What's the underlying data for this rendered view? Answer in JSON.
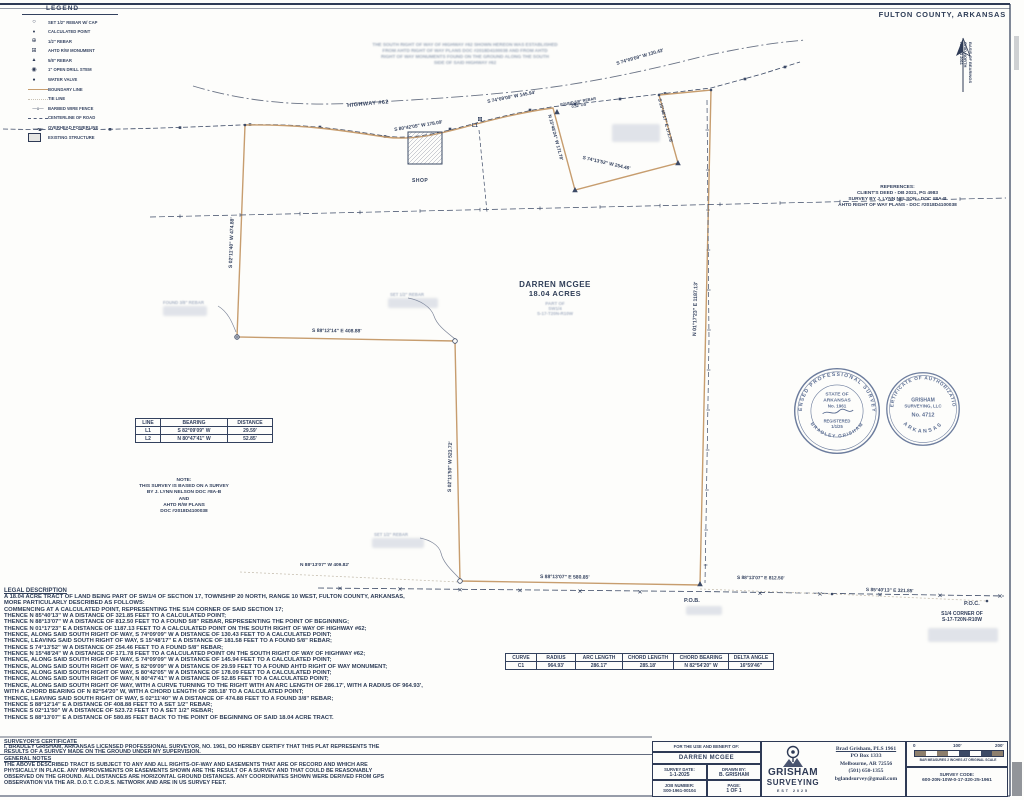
{
  "page": {
    "county_title": "FULTON COUNTY, ARKANSAS"
  },
  "legend": {
    "title": "LEGEND",
    "items": [
      {
        "icon": "set-rebar-cap-icon",
        "label": "SET 1/2\" REBAR W/ CAP"
      },
      {
        "icon": "calculated-point-icon",
        "label": "CALCULATED POINT"
      },
      {
        "icon": "half-inch-rebar-icon",
        "label": "1/2\" REBAR"
      },
      {
        "icon": "ahtd-rw-monument-icon",
        "label": "AHTD R/W MONUMENT"
      },
      {
        "icon": "five-eighths-rebar-icon",
        "label": "5/8\" REBAR"
      },
      {
        "icon": "drill-stem-icon",
        "label": "1\" OPEN DRILL STEM"
      },
      {
        "icon": "water-valve-icon",
        "label": "WATER VALVE"
      },
      {
        "icon": "boundary-line-icon",
        "label": "BOUNDARY LINE"
      },
      {
        "icon": "tie-line-icon",
        "label": "TIE LINE"
      },
      {
        "icon": "barbed-wire-fence-icon",
        "label": "BARBED WIRE FENCE"
      },
      {
        "icon": "centerline-of-road-icon",
        "label": "CENTERLINE OF ROAD"
      },
      {
        "icon": "overhead-powerline-icon",
        "label": "OVERHEAD POWERLINE"
      },
      {
        "icon": "existing-structure-icon",
        "label": "EXISTING STRUCTURE"
      }
    ]
  },
  "north_arrow": {
    "lines": [
      "BASIS OF BEARINGS",
      "GRID NORTH",
      "NAD83 2011"
    ]
  },
  "row_note": {
    "lines": [
      "THE SOUTH RIGHT OF WAY OF HIGHWAY #62 SHOWN HEREON WAS ESTABLISHED",
      "FROM AHTD RIGHT OF WAY PLANS DOC #2018D4100038 AND FROM AHTD",
      "RIGHT OF WAY MONUMENTS FOUND ON THE GROUND ALONG THE SOUTH",
      "SIDE OF SAID HIGHWAY #62"
    ]
  },
  "references": {
    "title": "REFERENCES:",
    "lines": [
      "CLIENT'S DEED - DB 2021, PG 4983",
      "SURVEY BY J. LYNN NELSON - DOC #8A-B",
      "AHTD RIGHT OF WAY PLANS - DOC #2018D4100038"
    ]
  },
  "tract": {
    "owner": "DARREN MCGEE",
    "area": "18.04 ACRES",
    "sub1": "PART OF",
    "sub2": "SW1/4",
    "sub3": "S-17-T20N-R10W"
  },
  "labels": {
    "highway": "HIGHWAY #62",
    "shop": "SHOP",
    "pob": "P.O.B.",
    "poc": "P.O.C.",
    "corner1": "S1/4 CORNER OF",
    "corner2": "S-17-T20N-R10W",
    "l1": "L1",
    "found_rebar": "FOUND 5/8\" REBAR",
    "found_rebar_os": "0.52' OS",
    "faint_found38": "FOUND 3/8\" REBAR",
    "faint_set12_a": "SET 1/2\" REBAR",
    "faint_set12_b": "SET 1/2\" REBAR"
  },
  "bearings": {
    "hw145": "S 74°09'09\" W 145.94'",
    "hw130": "S 74°09'09\" W 130.43'",
    "hw178": "S 80°42'05\" W 178.09'",
    "notch_w": "N 15°48'24\" W 171.78'",
    "notch_e": "S 15°48'17\" E 171.78'",
    "notch_s": "S 74°13'52\" W 254.46'",
    "east": "N 01°17'23\" E 1187.13'",
    "west": "S 02°11'40\" W 474.88'",
    "step": "S 88°12'14\" E 408.88'",
    "mid": "S 02°11'50\" W 523.72'",
    "south": "S 88°13'07\" E 580.85'",
    "tie_w": "N 88°13'07\" W 409.82'",
    "tie_e": "S 88°13'07\" E 812.50'",
    "poc_tie": "S 85°40'13\" E 321.85'"
  },
  "note_block": {
    "lines": [
      "NOTE:",
      "THIS SURVEY IS BASED ON A SURVEY",
      "BY J. LYNN NELSON DOC #8A-B",
      "AND",
      "AHTD R/W PLANS",
      "DOC #2018D4100038"
    ]
  },
  "line_table": {
    "headers": [
      "LINE",
      "BEARING",
      "DISTANCE"
    ],
    "rows": [
      [
        "L1",
        "S 82°09'09\" W",
        "29.59'"
      ],
      [
        "L2",
        "N 80°47'41\" W",
        "52.85'"
      ]
    ]
  },
  "curve_table": {
    "headers": [
      "CURVE",
      "RADIUS",
      "ARC LENGTH",
      "CHORD LENGTH",
      "CHORD BEARING",
      "DELTA ANGLE"
    ],
    "rows": [
      [
        "C1",
        "964.93'",
        "286.17'",
        "285.18'",
        "N 82°54'20\" W",
        "16°59'46\""
      ]
    ]
  },
  "legal": {
    "title": "LEGAL DESCRIPTION",
    "lines": [
      "A 18.04 ACRE TRACT OF LAND BEING PART OF SW1/4 OF SECTION 17, TOWNSHIP 20 NORTH, RANGE 10 WEST, FULTON COUNTY, ARKANSAS,",
      "MORE PARTICULARLY DESCRIBED AS FOLLOWS:",
      "COMMENCING AT A CALCULATED POINT, REPRESENTING THE S1/4 CORNER OF SAID SECTION 17;",
      "THENCE N 85°40'13\" W A DISTANCE OF 321.85 FEET TO A CALCULATED POINT;",
      "THENCE N 88°13'07\" W A DISTANCE OF 812.50 FEET TO A FOUND 5/8\" REBAR, REPRESENTING THE POINT OF BEGINNING;",
      "THENCE N 01°17'23\" E A DISTANCE OF 1187.13 FEET TO A CALCULATED POINT ON THE SOUTH RIGHT OF WAY OF HIGHWAY #62;",
      "THENCE, ALONG SAID SOUTH RIGHT OF WAY, S 74°09'09\" W A DISTANCE OF 130.43 FEET TO A CALCULATED POINT;",
      "THENCE, LEAVING SAID SOUTH RIGHT OF WAY, S 15°48'17\" E A DISTANCE OF 181.58 FEET TO A FOUND 5/8\" REBAR;",
      "THENCE S 74°13'52\" W A DISTANCE OF 254.46 FEET TO A FOUND 5/8\" REBAR;",
      "THENCE N 15°48'24\" W A DISTANCE OF 171.78 FEET TO A CALCULATED POINT ON THE SOUTH RIGHT OF WAY OF HIGHWAY #62;",
      "THENCE, ALONG SAID SOUTH RIGHT OF WAY, S 74°09'09\" W A DISTANCE OF 145.94 FEET TO A CALCULATED POINT;",
      "THENCE, ALONG SAID SOUTH RIGHT OF WAY, S 82°09'09\" W A DISTANCE OF 29.59 FEET TO A FOUND AHTD RIGHT OF WAY MONUMENT;",
      "THENCE, ALONG SAID SOUTH RIGHT OF WAY, S 80°42'05\" W A DISTANCE OF 178.09 FEET TO A CALCULATED POINT;",
      "THENCE, ALONG SAID SOUTH RIGHT OF WAY, N 80°47'41\" W A DISTANCE OF 52.85 FEET TO A CALCULATED POINT;",
      "THENCE, ALONG SAID SOUTH RIGHT OF WAY, WITH A CURVE TURNING TO THE RIGHT WITH AN ARC LENGTH OF 286.17', WITH A RADIUS OF 964.93',",
      "WITH A CHORD BEARING OF N 82°54'20\" W, WITH A CHORD LENGTH OF 285.18' TO A CALCULATED POINT;",
      "THENCE, LEAVING SAID SOUTH RIGHT OF WAY, S 02°11'40\" W A DISTANCE OF 474.88 FEET TO A FOUND 3/8\" REBAR;",
      "THENCE S 88°12'14\" E A DISTANCE OF 408.88 FEET TO A SET 1/2\" REBAR;",
      "THENCE S 02°11'50\" W A DISTANCE OF 523.72 FEET TO A SET 1/2\" REBAR;",
      "THENCE S 88°13'07\" E A DISTANCE OF 580.85 FEET BACK TO THE POINT OF BEGINNING OF SAID 18.04 ACRE TRACT."
    ]
  },
  "cert": {
    "title": "SURVEYOR'S CERTIFICATE",
    "lines": [
      "I, BRADLEY GRISHAM, ARKANSAS LICENSED PROFESSIONAL SURVEYOR, NO. 1961, DO HEREBY CERTIFY THAT THIS PLAT REPRESENTS THE",
      "RESULTS OF A SURVEY MADE ON THE GROUND UNDER MY SUPERVISION."
    ]
  },
  "notes": {
    "title": "GENERAL NOTES",
    "lines": [
      "THE ABOVE DESCRIBED TRACT IS SUBJECT TO ANY AND ALL RIGHTS-OF-WAY AND EASEMENTS THAT ARE OF RECORD AND WHICH ARE",
      "PHYSICALLY IN PLACE. ANY IMPROVEMENTS OR EASEMENTS SHOWN ARE THE RESULT OF A SURVEY AND THAT COULD BE REASONABLY",
      "OBSERVED ON THE GROUND. ALL DISTANCES ARE HORIZONTAL GROUND DISTANCES. ANY COORDINATES SHOWN WERE DERIVED FROM GPS",
      "OBSERVATION VIA THE AR. D.O.T. C.O.R.S. NETWORK AND ARE IN US SURVEY FEET."
    ]
  },
  "seal_pls": {
    "ring": "LICENSED PROFESSIONAL SURVEYOR",
    "state1": "STATE OF",
    "state2": "ARKANSAS",
    "number": "No. 1961",
    "registered": "REGISTERED",
    "date": "1/1/25",
    "name": "BRADLEY GRISHAM"
  },
  "seal_coa": {
    "ring": "CERTIFICATE OF AUTHORIZATION",
    "firm1": "GRISHAM",
    "firm2": "SURVEYING, LLC",
    "number": "No. 4712",
    "state": "ARKANSAS"
  },
  "title_block": {
    "use_label": "FOR THE USE AND BENEFIT OF:",
    "client": "DARREN MCGEE",
    "survey_date_label": "SURVEY DATE:",
    "survey_date": "1-1-2025",
    "drawn_by_label": "DRAWN BY:",
    "drawn_by": "B. GRISHAM",
    "job_label": "JOB NUMBER:",
    "job_number": "S00-1961-00104",
    "page_label": "PAGE:",
    "page": "1 OF 1",
    "firm_name1": "GRISHAM",
    "firm_name2": "SURVEYING",
    "firm_est": "EST  2025",
    "contact_lines": [
      "Brad Grisham, PLS 1961",
      "PO Box 1333",
      "Melbourne, AR 72556",
      "(501) 650-1355",
      "bglandsurvey@gmail.com"
    ],
    "scale": {
      "tick0": "0",
      "tick100": "100'",
      "tick200": "200'",
      "note": "BAR MEASURES 2 INCHES AT ORIGINAL SCALE"
    },
    "survey_code_label": "SURVEY CODE:",
    "survey_code": "600-20N-10W-0-17-320-25-1961"
  }
}
